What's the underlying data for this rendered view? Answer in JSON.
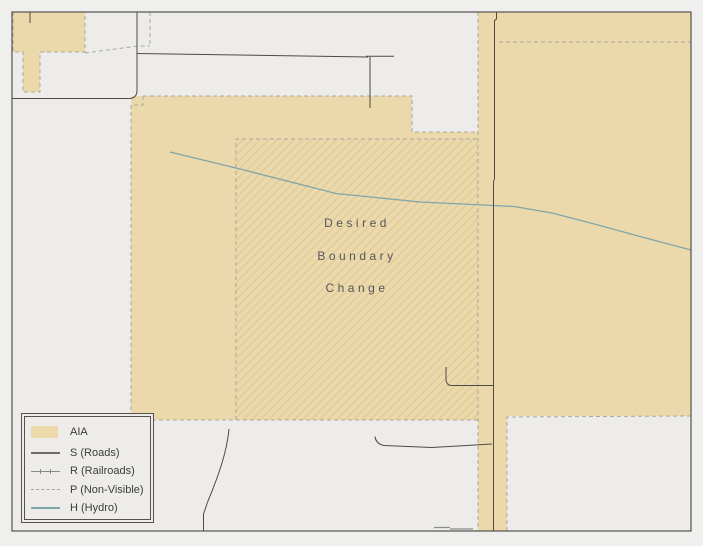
{
  "map": {
    "annotation": {
      "lines": [
        "Desired",
        "Boundary",
        "Change"
      ]
    },
    "colors": {
      "page_bg": "#efefed",
      "map_bg": "#edecea",
      "frame": "#55524d",
      "aia_fill": "#ecd9ab",
      "hatch_line": "#d9c08d",
      "boundary_dash": "#a7a7a2",
      "road": "#4e4b46",
      "road_minor": "#8a8a86",
      "hydro": "#7fa6ab",
      "annotation_text": "#54565c",
      "legend_text": "#3c3c3a"
    }
  },
  "legend": {
    "items": [
      {
        "id": "aia",
        "label": "AIA"
      },
      {
        "id": "roads",
        "label": "S (Roads)"
      },
      {
        "id": "railroads",
        "label": "R (Railroads)"
      },
      {
        "id": "non_visible",
        "label": "P (Non-Visible)"
      },
      {
        "id": "hydro",
        "label": "H (Hydro)"
      }
    ]
  }
}
